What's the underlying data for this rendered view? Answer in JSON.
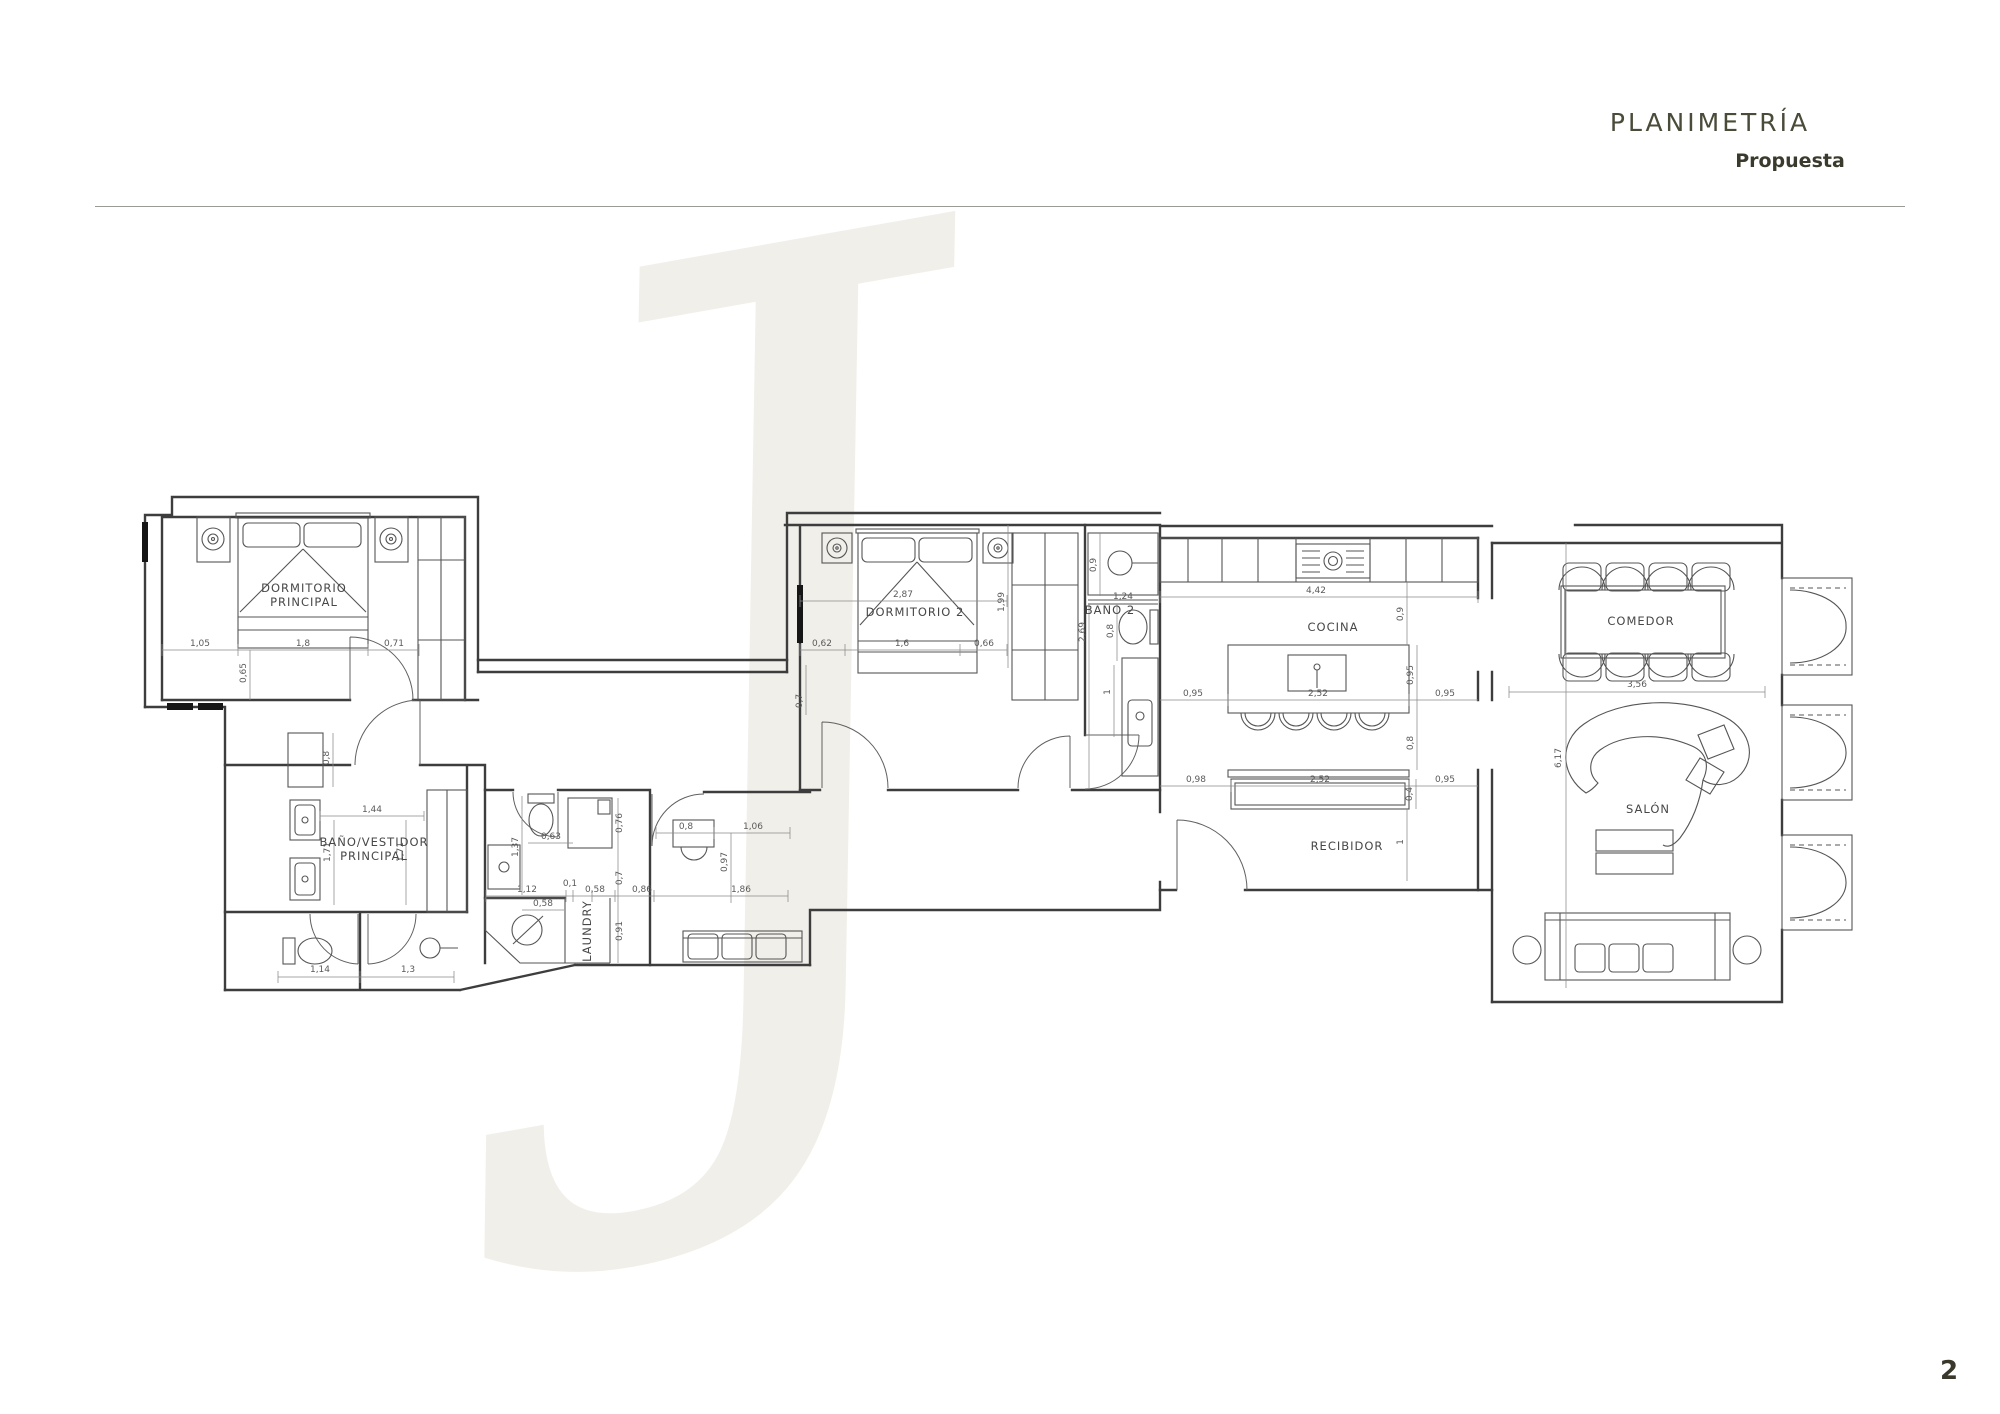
{
  "header": {
    "title": "PLANIMETRÍA",
    "subtitle": "Propuesta"
  },
  "page_number": "2",
  "watermark": "J",
  "rooms": {
    "dormitorio_principal": {
      "line1": "DORMITORIO",
      "line2": "PRINCIPAL"
    },
    "bano_vestidor": {
      "line1": "BAÑO/VESTIDOR",
      "line2": "PRINCIPAL"
    },
    "laundry": {
      "label": "LAUNDRY"
    },
    "dormitorio_2": {
      "label": "DORMITORIO  2"
    },
    "bano_2": {
      "label": "BAÑO  2"
    },
    "cocina": {
      "label": "COCINA"
    },
    "recibidor": {
      "label": "RECIBIDOR"
    },
    "comedor": {
      "label": "COMEDOR"
    },
    "salon": {
      "label": "SALÓN"
    }
  },
  "dims": {
    "dp_left": "1,05",
    "dp_bed": "1,8",
    "dp_right": "0,71",
    "dp_foot": "0,65",
    "bv_cab": "0,8",
    "bv_width": "1,44",
    "bv_depth_l": "1,71",
    "bv_depth_r": "1,71",
    "wc_left": "1,14",
    "wc_right": "1,3",
    "aseo_toilet": "0,63",
    "aseo_depth": "1,37",
    "aseo_width": "1,12",
    "aseo_shower": "0,76",
    "aseo_corr": "0,7",
    "la_gap": "0,1",
    "la_width": "0,58",
    "la_width2": "0,58",
    "la_height": "0,91",
    "hall_desk": "0,8",
    "hall_right": "1,06",
    "hall_depth": "0,97",
    "hall_w1": "0,86",
    "hall_w2": "1,86",
    "d2_width": "2,87",
    "d2_depth": "1,99",
    "d2_left": "0,62",
    "d2_bed": "1,6",
    "d2_right": "0,66",
    "d2_door": "0,7",
    "b2_shower": "0,9",
    "b2_ledge": "1,24",
    "b2_depth": "2,69",
    "b2_wc": "0,8",
    "b2_sink": "1",
    "k_width": "4,42",
    "k_top": "0,9",
    "k_left": "0,95",
    "k_island": "2,52",
    "k_right": "0,95",
    "k_island_d": "0,95",
    "k_gap": "0,8",
    "r_left": "0,98",
    "r_console": "2,52",
    "r_right": "0,95",
    "r_console_d": "0,4",
    "r_pass": "1",
    "c_width": "3,56",
    "s_depth": "6,17"
  }
}
